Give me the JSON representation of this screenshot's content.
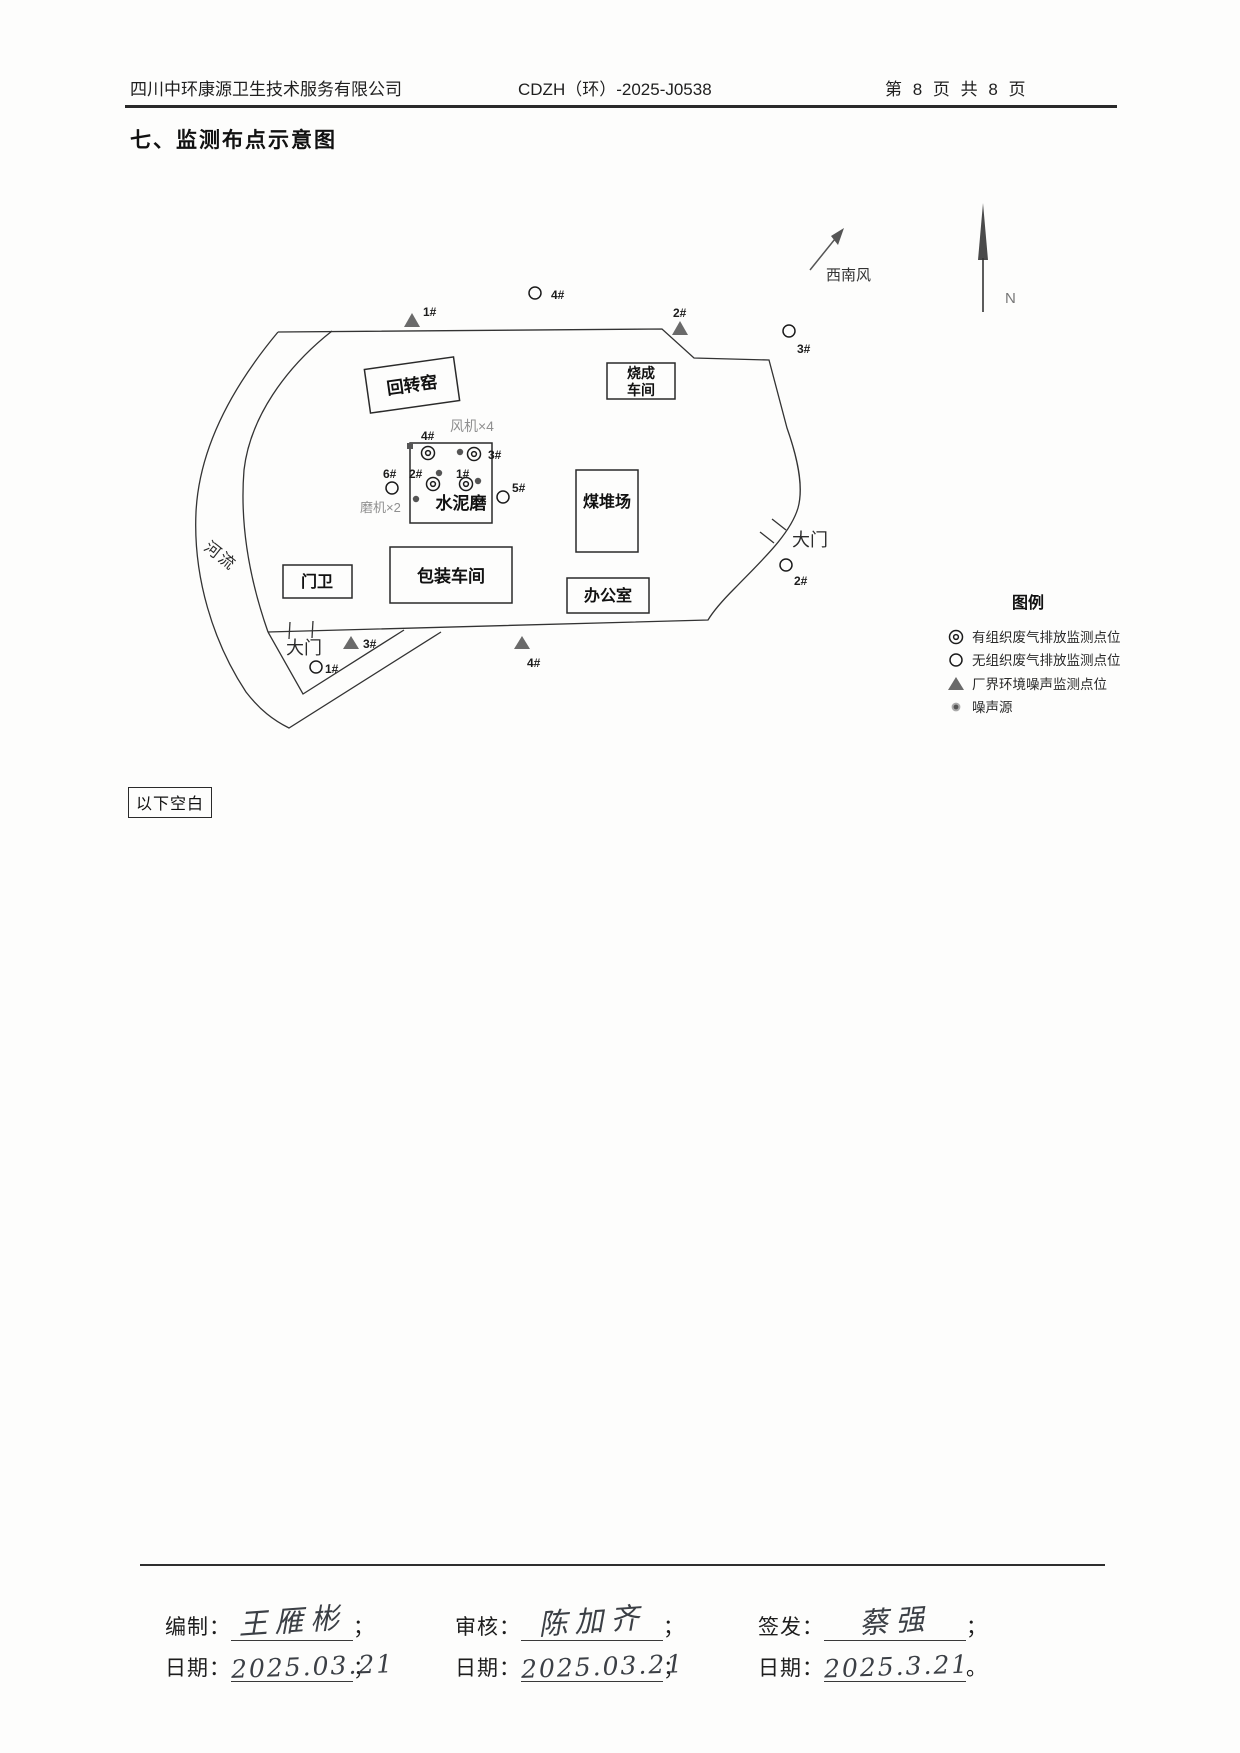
{
  "header": {
    "company": "四川中环康源卫生技术服务有限公司",
    "doc_number": "CDZH（环）-2025-J0538",
    "page_info": "第 8 页 共 8 页"
  },
  "page_title": "七、监测布点示意图",
  "diagram": {
    "north_label": "N",
    "wind_label": "西南风",
    "river_label": "河流",
    "gate_right": "大门",
    "gate_bottom": "大门",
    "fans_label": "风机×4",
    "mills_label": "磨机×2",
    "buildings": {
      "rotary_kiln": "回转窑",
      "firing_workshop": [
        "烧成",
        "车间"
      ],
      "cement_mill": "水泥磨",
      "coal_yard": "煤堆场",
      "packing_workshop": "包装车间",
      "office": "办公室",
      "gatehouse": "门卫"
    },
    "ids": {
      "n1": "1#",
      "n2": "2#",
      "n3": "3#",
      "n4": "4#",
      "n5": "5#",
      "n6": "6#"
    }
  },
  "legend": {
    "title": "图例",
    "items": [
      "有组织废气排放监测点位",
      "无组织废气排放监测点位",
      "厂界环境噪声监测点位",
      "噪声源"
    ]
  },
  "blank_note": "以下空白",
  "footer": {
    "row1": [
      {
        "label": "编制：",
        "value": "王雁彬",
        "suffix": "；"
      },
      {
        "label": "审核：",
        "value": "陈加齐",
        "suffix": "；"
      },
      {
        "label": "签发：",
        "value": "蔡强",
        "suffix": "；"
      }
    ],
    "row2": [
      {
        "label": "日期：",
        "value": "2025.03.21",
        "suffix": "；"
      },
      {
        "label": "日期：",
        "value": "2025.03.21",
        "suffix": "；"
      },
      {
        "label": "日期：",
        "value": "2025.3.21",
        "suffix": "。"
      }
    ]
  },
  "colors": {
    "line": "#333333",
    "triangle": "#6a6a6a",
    "noise_dot": "#555555",
    "gray_label": "#8f8f8f"
  }
}
